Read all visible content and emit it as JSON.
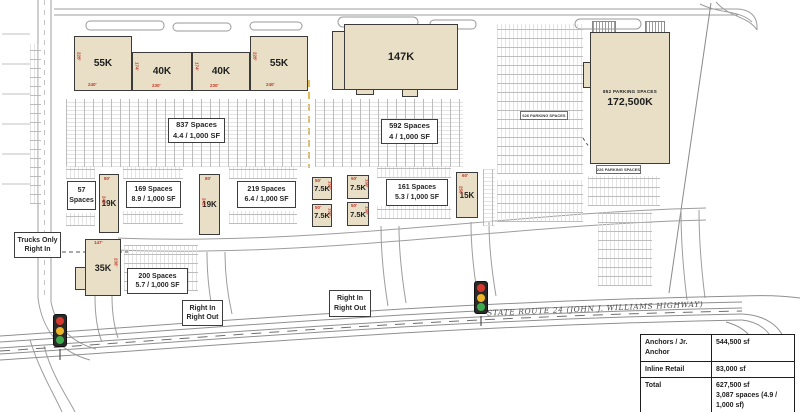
{
  "buildings": [
    {
      "label": "55K",
      "dim_bottom": "240'",
      "dim_side": "228'"
    },
    {
      "label": "40K",
      "dim_bottom": "230'",
      "dim_side": "174'"
    },
    {
      "label": "40K",
      "dim_bottom": "230'",
      "dim_side": "174'"
    },
    {
      "label": "55K",
      "dim_bottom": "240'",
      "dim_side": "228'"
    },
    {
      "label": "147K"
    },
    {
      "label": "19K",
      "dim_top": "80'",
      "dim_side": "242'"
    },
    {
      "label": "19K",
      "dim_top": "80'",
      "dim_side": "242'"
    },
    {
      "label": "7.5K",
      "dim_top": "50'",
      "dim_side": "150'"
    },
    {
      "label": "7.5K",
      "dim_top": "50'",
      "dim_side": "150'"
    },
    {
      "label": "7.5K",
      "dim_top": "50'",
      "dim_side": "150'"
    },
    {
      "label": "7.5K",
      "dim_top": "50'",
      "dim_side": "150'"
    },
    {
      "label": "15K",
      "dim_top": "60'",
      "dim_side": "250'"
    },
    {
      "label": "35K",
      "dim_top": "147'",
      "dim_side": "238'"
    },
    {
      "label": "172,500K",
      "sublabel": "852 PARKING SPACES"
    }
  ],
  "labels": [
    {
      "l1": "837 Spaces",
      "l2": "4.4 / 1,000 SF"
    },
    {
      "l1": "592 Spaces",
      "l2": "4 / 1,000 SF"
    },
    {
      "l1": "57",
      "l2": "Spaces"
    },
    {
      "l1": "169 Spaces",
      "l2": "8.9 / 1,000 SF"
    },
    {
      "l1": "219 Spaces",
      "l2": "6.4 / 1,000 SF"
    },
    {
      "l1": "161 Spaces",
      "l2": "5.3 / 1,000 SF"
    },
    {
      "l1": "200 Spaces",
      "l2": "5.7 / 1,000 SF"
    }
  ],
  "signs": [
    {
      "l1": "Trucks Only",
      "l2": "Right In"
    },
    {
      "l1": "Right In",
      "l2": "Right Out"
    },
    {
      "l1": "Right In",
      "l2": "Right Out"
    }
  ],
  "parking_tags": [
    "626 PARKING SPACES",
    "226 PARKING SPACES"
  ],
  "road": {
    "name": "STATE ROUTE 24 (JOHN J. WILLIAMS HIGHWAY)"
  },
  "summary_table": {
    "rows": [
      {
        "label": "Anchors / Jr. Anchor",
        "value": "544,500 sf"
      },
      {
        "label": "Inline Retail",
        "value": "83,000 sf"
      },
      {
        "label": "Total",
        "value": "627,500 sf\n3,087 spaces (4.9 / 1,000 sf)"
      }
    ]
  },
  "colors": {
    "building_fill": "#e8dfc6",
    "building_border": "#3b3b3b",
    "dimension_red": "#c0392b",
    "phase_line_orange": "#d9a520",
    "signal_red": "#d63a2f",
    "signal_yellow": "#f0b429",
    "signal_green": "#3faa4c"
  }
}
